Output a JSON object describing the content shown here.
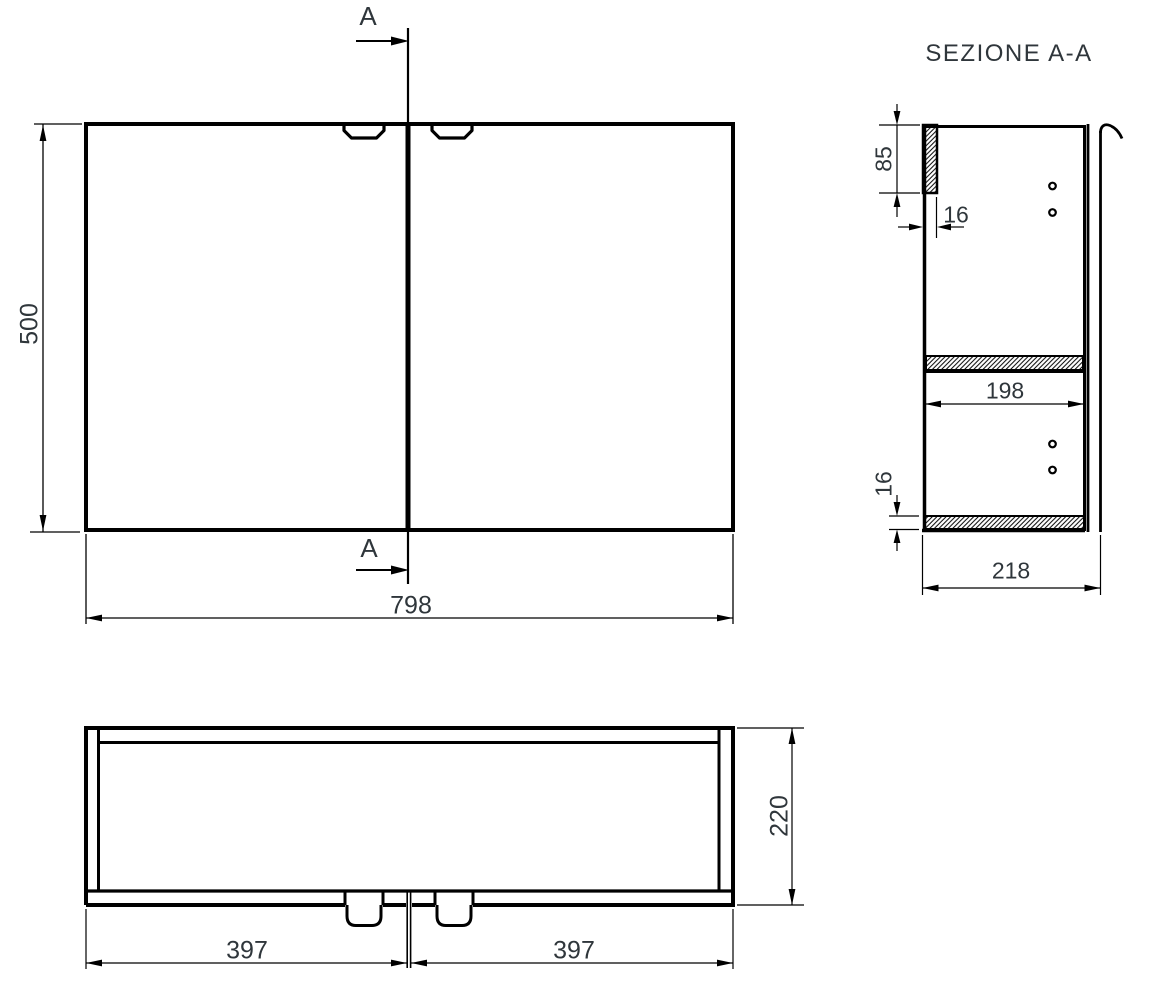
{
  "drawing": {
    "section_title": "SEZIONE A-A",
    "markers": {
      "cut_line_top": "A",
      "cut_line_bottom": "A"
    },
    "front_view": {
      "height_mm": "500",
      "width_mm": "798"
    },
    "section_view": {
      "top_rail_height_mm": "85",
      "top_rail_thickness_mm": "16",
      "inner_depth_mm": "198",
      "bottom_panel_thickness_mm": "16",
      "total_depth_mm": "218"
    },
    "plan_view": {
      "left_door_width_mm": "397",
      "right_door_width_mm": "397",
      "depth_mm": "220"
    },
    "colors": {
      "line": "#000000",
      "text": "#2f363b",
      "background": "#ffffff"
    }
  }
}
